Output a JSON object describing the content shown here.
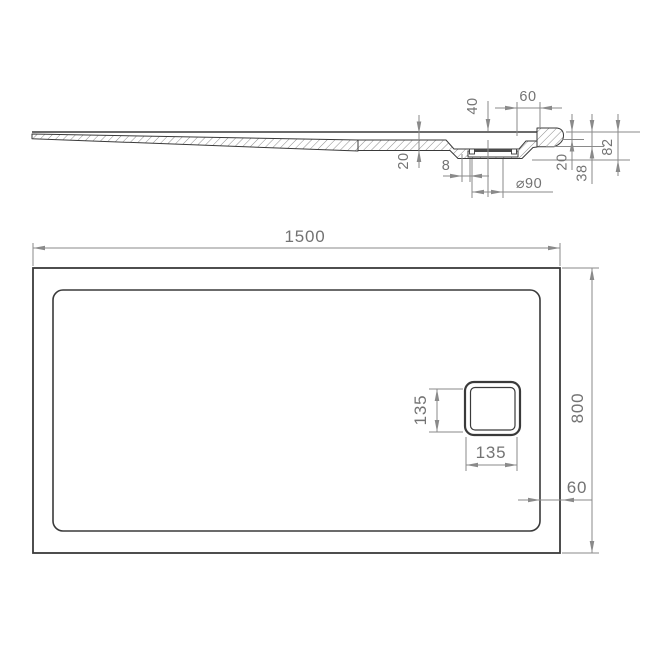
{
  "diagram": {
    "kind": "technical-drawing",
    "subject": "rectangular shower tray with offset square drain - side section and plan view",
    "units": "mm",
    "colors": {
      "background": "#ffffff",
      "outline": "#3a3a3a",
      "dimension_lines": "#8a8a8a",
      "dimension_text": "#737373"
    },
    "side_view": {
      "dims": {
        "drain_offset": "40",
        "edge_offset": "60",
        "floor_thickness": "20",
        "recess_step": "8",
        "drain_diameter": "⌀90",
        "lip_height": "20",
        "edge_height": "38",
        "total_height": "82"
      }
    },
    "plan_view": {
      "dims": {
        "length": "1500",
        "width": "800",
        "drain_size_vertical": "135",
        "drain_size_horizontal": "135",
        "border_width": "60"
      }
    }
  }
}
